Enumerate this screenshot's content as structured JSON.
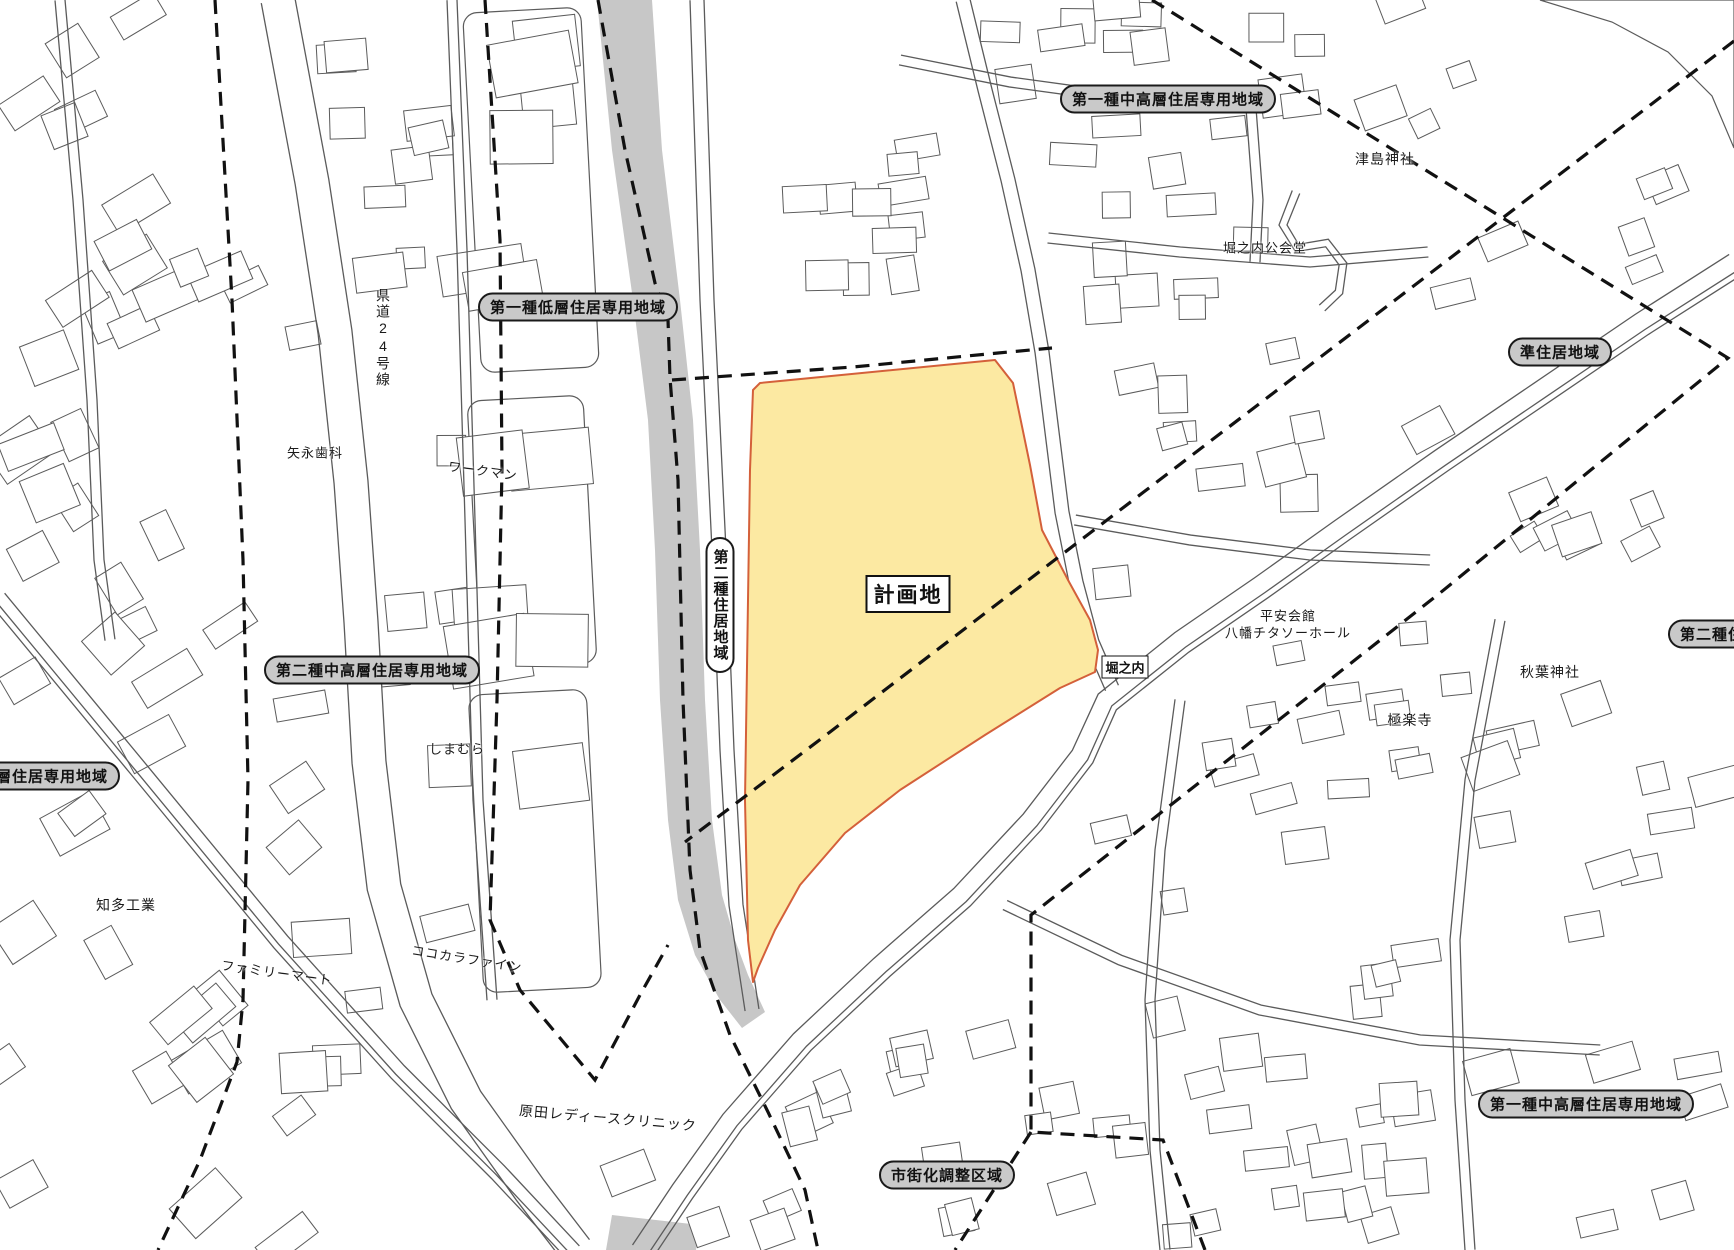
{
  "map": {
    "colors": {
      "site_fill": "#fce9a2",
      "site_stroke": "#d4603a",
      "river_gray": "#c7c7c7",
      "pill_bg": "#c9c9c9",
      "line_gray": "#5b5b5b",
      "boundary_black": "#111111"
    },
    "zone_pills": [
      {
        "id": "pill-1chuko-top",
        "label": "第一種中高層住居専用地域"
      },
      {
        "id": "pill-1teiso",
        "label": "第一種低層住居専用地域"
      },
      {
        "id": "pill-jun",
        "label": "準住居地域"
      },
      {
        "id": "pill-2chuko",
        "label": "第二種中高層住居専用地域"
      },
      {
        "id": "pill-cut-left",
        "label": "層住居専用地域"
      },
      {
        "id": "pill-2jukyo-v",
        "label": "第二種住居地域"
      },
      {
        "id": "pill-cut-right",
        "label": "第二種住"
      },
      {
        "id": "pill-1chuko-br",
        "label": "第一種中高層住居専用地域"
      },
      {
        "id": "pill-shigaika",
        "label": "市街化調整区域"
      }
    ],
    "boxed_labels": [
      {
        "id": "site-label",
        "label": "計画地"
      },
      {
        "id": "horinouchi-label",
        "label": "堀之内"
      }
    ],
    "place_labels": [
      {
        "id": "tsushima-shrine",
        "label": "津島神社"
      },
      {
        "id": "horinouchi-hall",
        "label": "堀之内公会堂"
      },
      {
        "id": "route-24",
        "label": "県道24号線"
      },
      {
        "id": "yanaga-dental",
        "label": "矢永歯科"
      },
      {
        "id": "workman",
        "label": "ワークマン"
      },
      {
        "id": "shimamura",
        "label": "しまむら"
      },
      {
        "id": "chita-kogyo",
        "label": "知多工業"
      },
      {
        "id": "family-mart",
        "label": "ファミリーマート"
      },
      {
        "id": "cocokara-fine",
        "label": "ココカラファイン"
      },
      {
        "id": "harada-clinic",
        "label": "原田レディースクリニック"
      },
      {
        "id": "heian-kaikan",
        "label": "平安会館"
      },
      {
        "id": "yawata-hall",
        "label": "八幡チタソーホール"
      },
      {
        "id": "gokurakuji",
        "label": "極楽寺"
      },
      {
        "id": "akiba-shrine",
        "label": "秋葉神社"
      }
    ]
  }
}
